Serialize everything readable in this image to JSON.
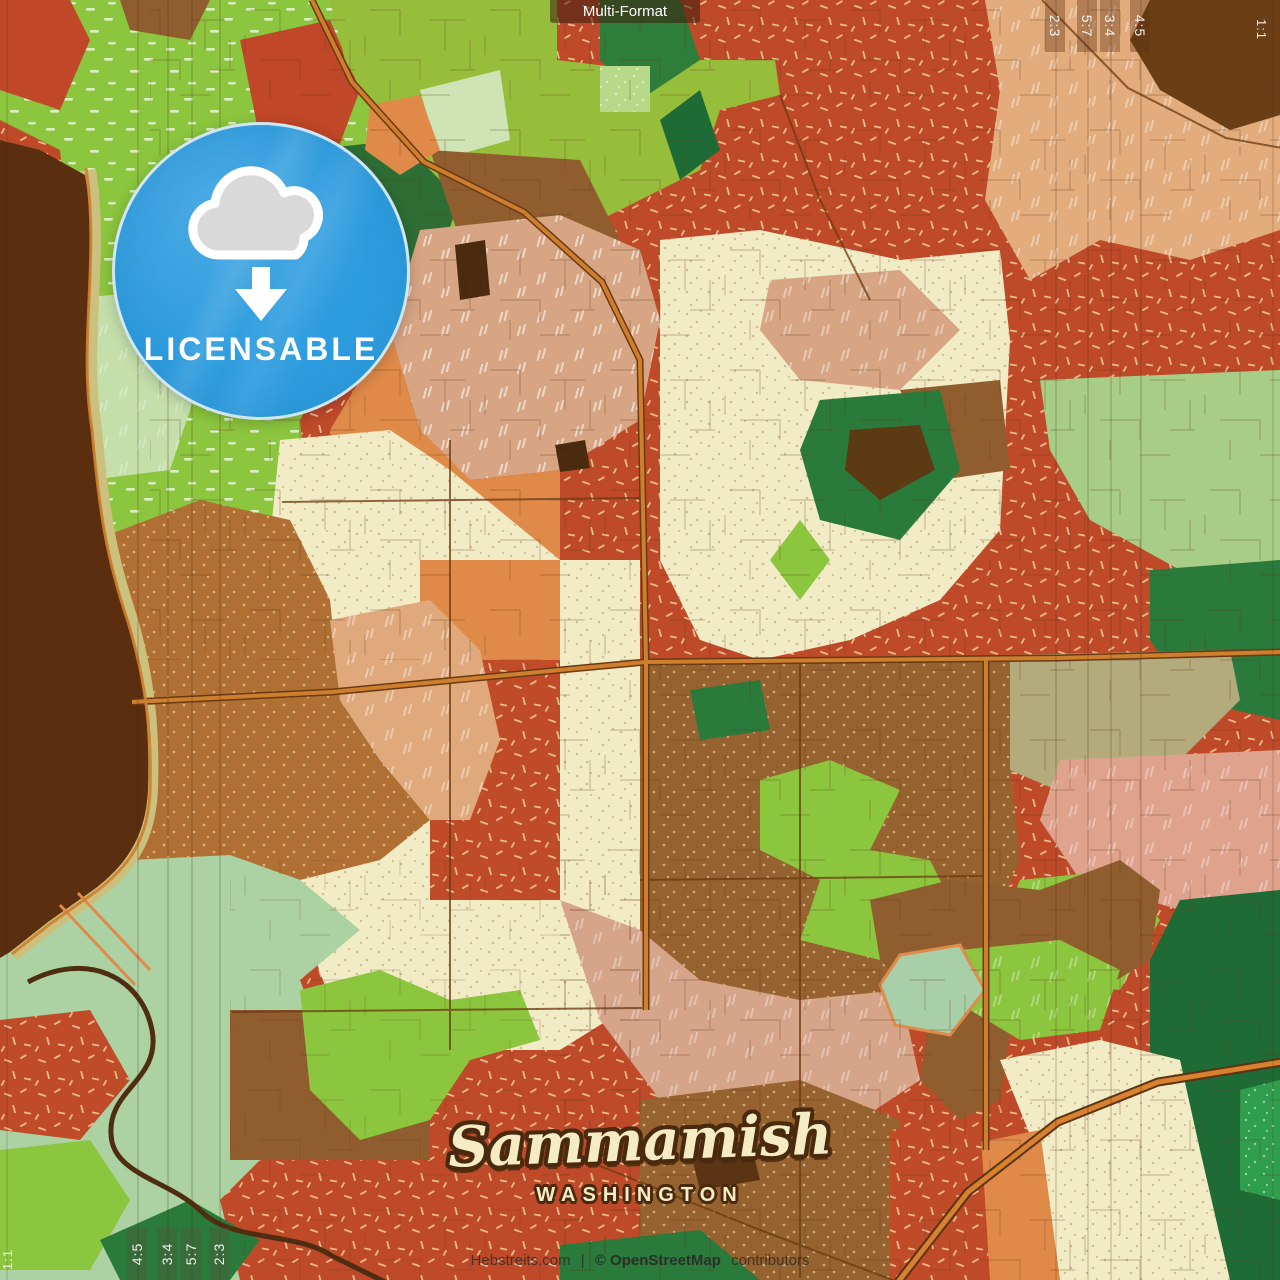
{
  "format_chip": {
    "label": "Multi-Format"
  },
  "badge": {
    "label": "LICENSABLE",
    "icon": "cloud-download-icon"
  },
  "map_title": {
    "city": "Sammamish",
    "state": "WASHINGTON"
  },
  "attribution": {
    "site": "Hebstreits.com",
    "separator": "|",
    "osm": "© OpenStreetMap",
    "suffix": "contributors"
  },
  "crop_marks": {
    "top_right": [
      "2:3",
      "5:7",
      "3:4",
      "4:5"
    ],
    "right_edge": "1:1",
    "bottom_left": [
      "4:5",
      "3:4",
      "5:7",
      "2:3"
    ],
    "left_edge": "1:1"
  },
  "palette": {
    "badge_blue": "#2D9CDE",
    "title_cream": "#F5ECC4",
    "outline_brown": "#4A2A0E",
    "map_red": "#BE4A2A",
    "map_cream": "#F2ECC6",
    "map_lime": "#8CC63E",
    "map_yellow_green": "#97BE3B",
    "map_sage": "#ACD1A2",
    "map_brown": "#8F5D2E",
    "map_brown_dotted": "#B06F33",
    "map_lake_brown": "#5A2E0F",
    "map_tan": "#E2AC7C",
    "map_pink_tan": "#D7A583",
    "map_orange": "#E08A4A",
    "map_dark_green": "#2A7A3C",
    "map_forest_green": "#1F6B35",
    "map_mid_green": "#2F9F4E",
    "map_khaki": "#B3AB7B",
    "map_salmon": "#DFA28D",
    "map_shore_olive": "#CBC07D",
    "road_orange": "#CE7F2E",
    "road_casing": "#6B3A12"
  }
}
